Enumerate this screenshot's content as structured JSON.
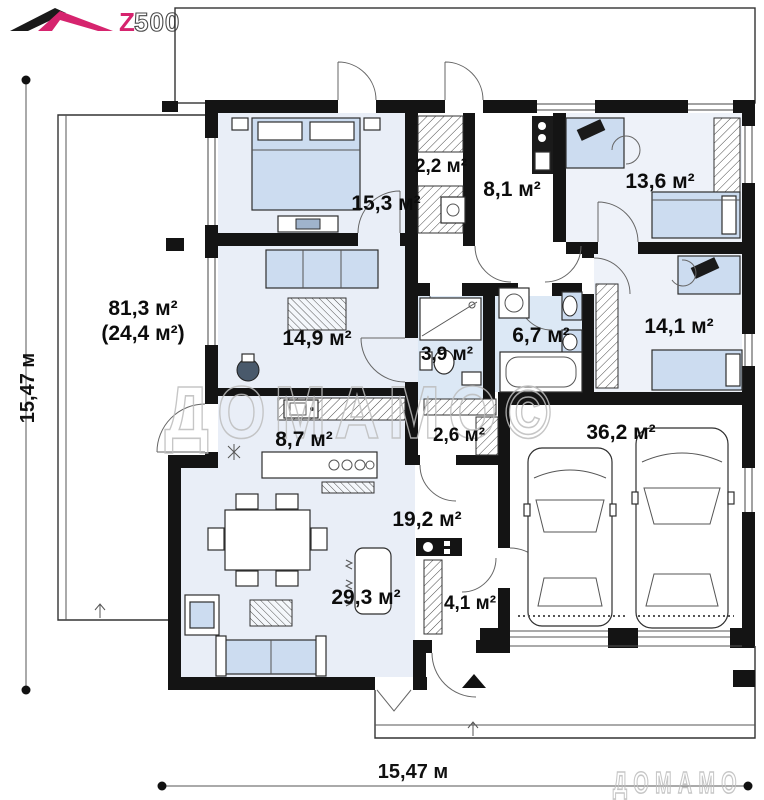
{
  "logo": {
    "brand": "Z500",
    "part_z": "Z",
    "part_500": "500"
  },
  "watermark": {
    "center": "ДОМАМО©",
    "corner": "ДОМАМО"
  },
  "dimensions": {
    "left": "15,47 м",
    "bottom": "15,47 м"
  },
  "terrace": {
    "line1": "81,3 м²",
    "line2": "(24,4 м²)"
  },
  "rooms": [
    {
      "name": "bedroom-main",
      "label": "15,3 м²"
    },
    {
      "name": "wardrobe",
      "label": "2,2 м²"
    },
    {
      "name": "hall",
      "label": "8,1 м²"
    },
    {
      "name": "bedroom-right",
      "label": "13,6 м²"
    },
    {
      "name": "study",
      "label": "14,9 м²"
    },
    {
      "name": "shower-room",
      "label": "3,9 м²"
    },
    {
      "name": "bathroom",
      "label": "6,7 м²"
    },
    {
      "name": "bedroom-lower",
      "label": "14,1 м²"
    },
    {
      "name": "kitchen",
      "label": "8,7 м²"
    },
    {
      "name": "closet",
      "label": "2,6 м²"
    },
    {
      "name": "garage",
      "label": "36,2 м²"
    },
    {
      "name": "hallway",
      "label": "19,2 м²"
    },
    {
      "name": "boiler-room",
      "label": "4,1 м²"
    },
    {
      "name": "living-room",
      "label": "29,3 м²"
    }
  ],
  "colors": {
    "wall": "#141414",
    "room_blue": "#e9eef7",
    "bath_blue": "#dce8f5",
    "furniture_blue": "#ccdcf0",
    "brand_magenta": "#d6246e",
    "watermark_gray": "#bdbdbd"
  }
}
